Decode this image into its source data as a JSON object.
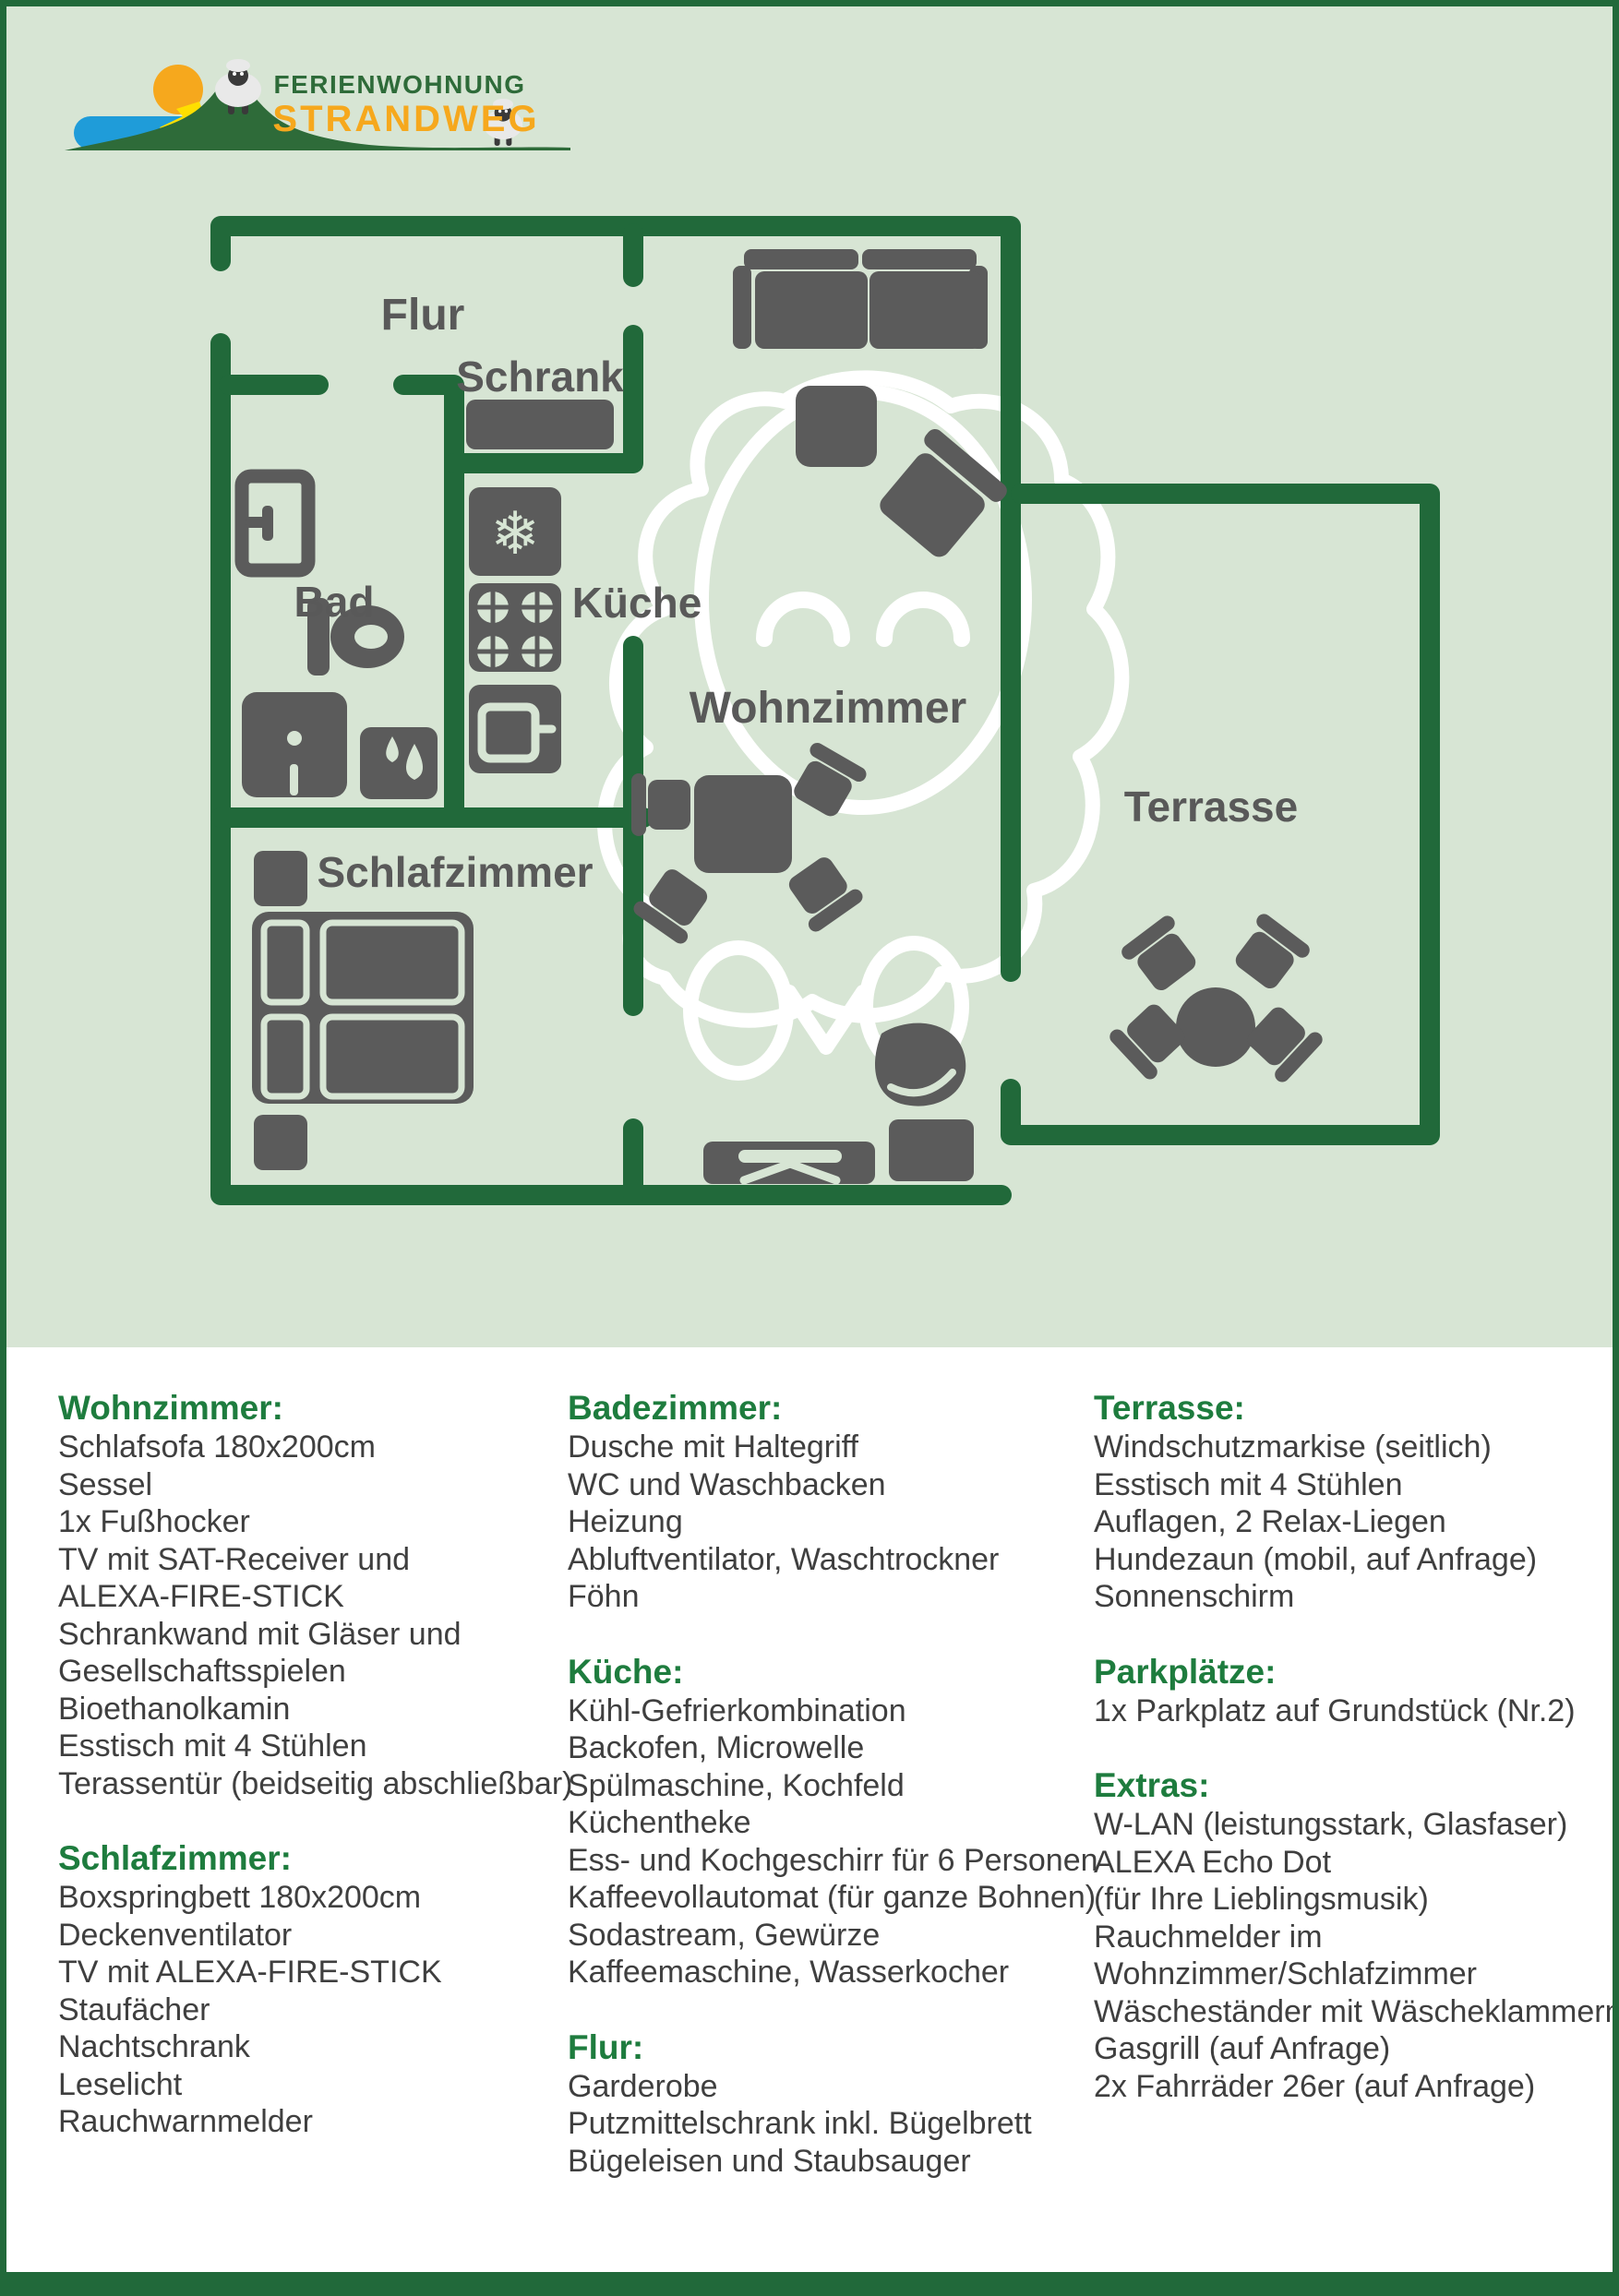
{
  "logo": {
    "line1": "FERIENWOHNUNG",
    "line2": "STRANDWEG"
  },
  "floor_plan": {
    "rooms": {
      "flur": "Flur",
      "schrank": "Schrank",
      "bad": "Bad",
      "kueche": "Küche",
      "wohnzimmer": "Wohnzimmer",
      "terrasse": "Terrasse",
      "schlafzimmer": "Schlafzimmer"
    },
    "icons": [
      "sheep-watermark",
      "door-icon",
      "toilet-icon",
      "shower-icon",
      "washer-drops-icon",
      "fridge-snowflake-icon",
      "stove-burners-icon",
      "oven-icon",
      "wardrobe-shelf-icon",
      "sofa-icon",
      "footstool-icon",
      "armchair-icon",
      "dining-table-icon",
      "chair-icon",
      "bed-icon",
      "nightstand-icon",
      "tv-board-icon",
      "cabinet-icon",
      "terrace-table-icon",
      "sun-icon",
      "hill-icon",
      "water-icon",
      "beach-icon",
      "sheep-logo-icon"
    ]
  },
  "colors": {
    "wall_green": "#21693A",
    "panel_green": "#D7E5D4",
    "furniture_gray": "#5B5B5B",
    "label_gray": "#595959",
    "heading_green": "#1E7C3E",
    "body_text": "#3F3F3F",
    "logo_orange": "#F6A81D",
    "logo_green": "#2E6B39",
    "logo_blue": "#1F9CD9",
    "logo_yellow": "#FFDF00"
  },
  "lists": {
    "columns": [
      {
        "sections": [
          {
            "heading": "Wohnzimmer:",
            "items": [
              "Schlafsofa 180x200cm",
              "Sessel",
              "1x Fußhocker",
              "TV mit SAT-Receiver und",
              "ALEXA-FIRE-STICK",
              "Schrankwand mit Gläser und",
              "Gesellschaftsspielen",
              "Bioethanolkamin",
              "Esstisch mit 4 Stühlen",
              "Terassentür (beidseitig abschließbar)"
            ]
          },
          {
            "heading": "Schlafzimmer:",
            "items": [
              "Boxspringbett 180x200cm",
              "Deckenventilator",
              "TV mit ALEXA-FIRE-STICK",
              "Staufächer",
              "Nachtschrank",
              "Leselicht",
              "Rauchwarnmelder"
            ]
          }
        ]
      },
      {
        "sections": [
          {
            "heading": "Badezimmer:",
            "items": [
              "Dusche mit Haltegriff",
              "WC und Waschbacken",
              "Heizung",
              "Abluftventilator, Waschtrockner",
              "Föhn"
            ]
          },
          {
            "heading": "Küche:",
            "items": [
              "Kühl-Gefrierkombination",
              "Backofen, Microwelle",
              "Spülmaschine, Kochfeld",
              "Küchentheke",
              "Ess- und Kochgeschirr für 6 Personen",
              "Kaffeevollautomat (für ganze Bohnen)",
              "Sodastream, Gewürze",
              "Kaffeemaschine, Wasserkocher"
            ]
          },
          {
            "heading": "Flur:",
            "items": [
              "Garderobe",
              "Putzmittelschrank inkl. Bügelbrett",
              "Bügeleisen und Staubsauger"
            ]
          }
        ]
      },
      {
        "sections": [
          {
            "heading": "Terrasse:",
            "items": [
              "Windschutzmarkise (seitlich)",
              "Esstisch mit 4 Stühlen",
              "Auflagen, 2 Relax-Liegen",
              "Hundezaun (mobil, auf Anfrage)",
              "Sonnenschirm"
            ]
          },
          {
            "heading": "Parkplätze:",
            "items": [
              "1x Parkplatz auf Grundstück (Nr.2)"
            ]
          },
          {
            "heading": "Extras:",
            "items": [
              "W-LAN (leistungsstark, Glasfaser)",
              "ALEXA Echo Dot",
              "(für Ihre Lieblingsmusik)",
              "Rauchmelder im",
              "Wohnzimmer/Schlafzimmer",
              "Wäscheständer mit Wäscheklammern",
              "Gasgrill (auf Anfrage)",
              "2x Fahrräder 26er (auf Anfrage)"
            ]
          }
        ]
      }
    ]
  }
}
